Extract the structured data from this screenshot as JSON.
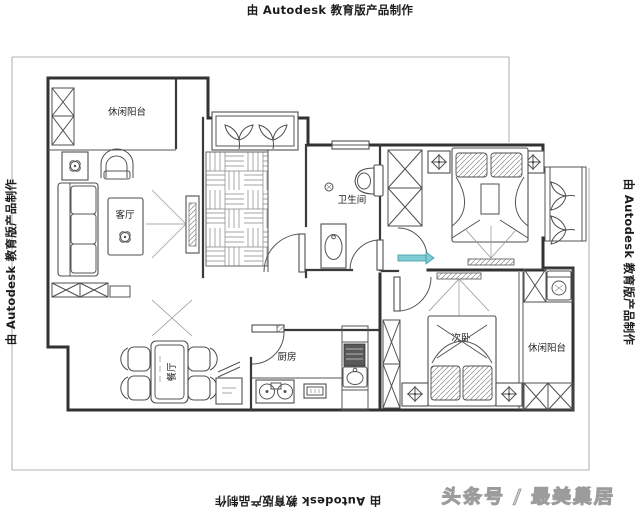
{
  "stamps": {
    "top": "由 Autodesk 教育版产品制作",
    "left": "由 Autodesk 教育版产品制作",
    "right": "由 Autodesk 教育版产品制作",
    "bottom": "由 Autodesk 教育版产品制作"
  },
  "watermark": {
    "text": "头条号 / 最美巢居"
  },
  "floorplan": {
    "rooms": {
      "balcony_top_left": {
        "label": "休闲阳台"
      },
      "living_room": {
        "label": "客厅"
      },
      "bathroom": {
        "label": "卫生间"
      },
      "dining_room": {
        "label": "餐厅"
      },
      "kitchen": {
        "label": "厨房"
      },
      "bedroom_second": {
        "label": "次卧"
      },
      "balcony_right": {
        "label": "休闲阳台"
      }
    },
    "colors": {
      "wall": "#323232",
      "accent_door": "#7fccd6",
      "watermark": "#c9c9c9"
    }
  }
}
